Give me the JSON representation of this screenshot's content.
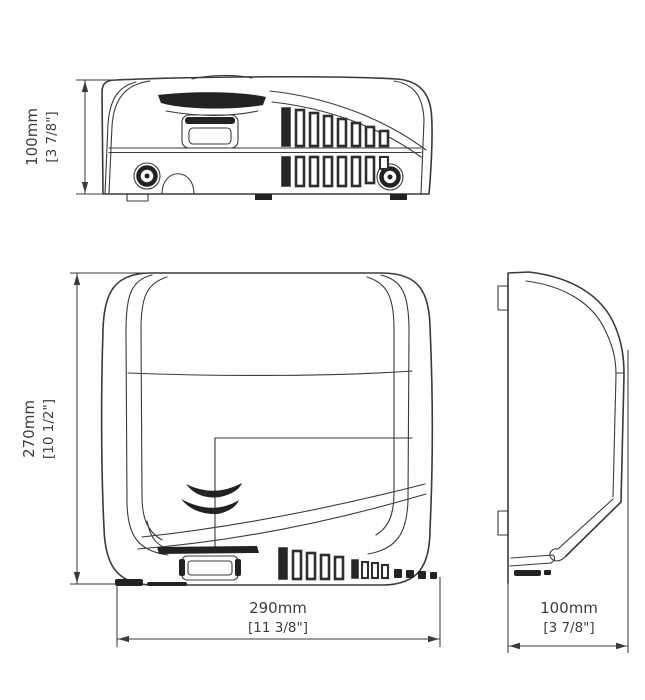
{
  "drawing": {
    "subject": "hand-dryer-technical-dimension-drawing",
    "views": [
      "top",
      "front",
      "side"
    ]
  },
  "dimensions": {
    "top_depth": {
      "mm": "100mm",
      "inch": "[3 7/8\"]"
    },
    "front_height": {
      "mm": "270mm",
      "inch": "[10 1/2\"]"
    },
    "front_width": {
      "mm": "290mm",
      "inch": "[11 3/8\"]"
    },
    "side_depth": {
      "mm": "100mm",
      "inch": "[3 7/8\"]"
    }
  },
  "colors": {
    "line": "#3a3a3a",
    "dark_fill": "#222222",
    "text": "#3d3d3d",
    "background": "#ffffff"
  }
}
